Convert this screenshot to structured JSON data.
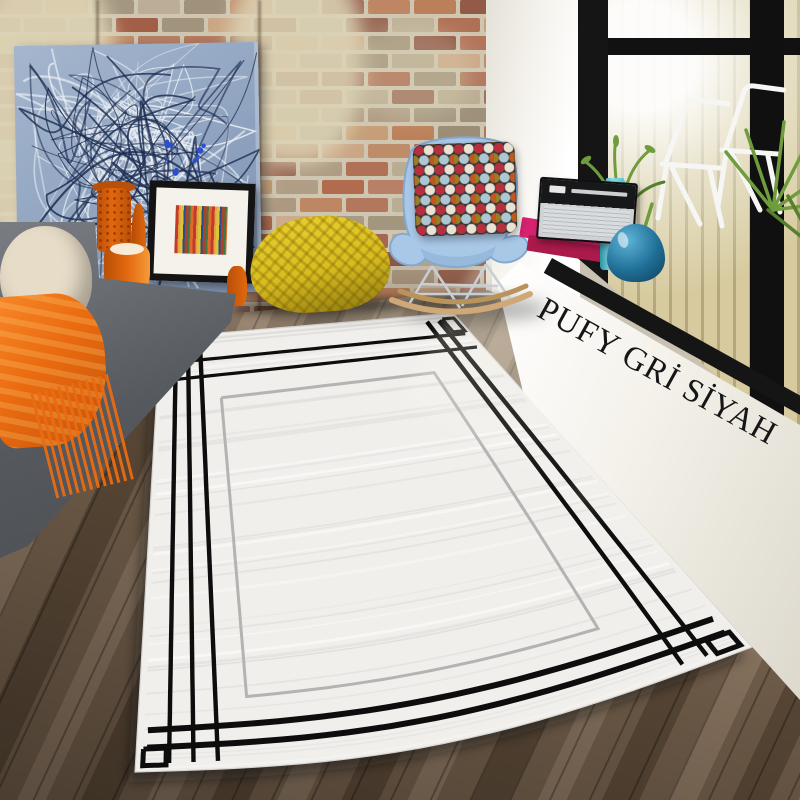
{
  "scene": {
    "description": "Living-room product photo: grey rug with black interlocking geometric border, brick wall, abstract painting, grey sofa with orange throw, yellow knit pouf, blue rocking chair, window ledge with radio, books and vases",
    "sill_text": "PUFY GRİ SİYAH"
  },
  "palette": {
    "wall_mortar": "#cfc6b2",
    "whitewash": "#ddd4b6",
    "white_wall": "#f5f3ed",
    "window_frame": "#151515",
    "slat": "#d6ca9e",
    "slat_dark": "#b5a77a",
    "leaf": "#6f9c3d",
    "leaf_dark": "#567f2e",
    "patio_chair": "#f6f6f4",
    "sill_face": "#f4f1ea",
    "text": "#161616",
    "floor_a": "#8a7560",
    "floor_b": "#74604c",
    "floor_c": "#5c4a38",
    "sofa_a": "#7a7d83",
    "sofa_b": "#55585d",
    "cushion": "#e7dcc7",
    "throw": "#ea6b10",
    "throw_dark": "#c4540a",
    "pouf": "#d9bd1f",
    "pouf_dark": "#8f7a10",
    "shell": "#a9c8e8",
    "shell_dark": "#84a9cf",
    "chrome": "#c9ced3",
    "rocker": "#cfa878",
    "pillow_base": "#30363a",
    "pillow_red": "#b5303c",
    "pillow_cream": "#e9e3d3",
    "pillow_blue": "#aec8d3",
    "pillow_olive": "#9c7d26",
    "pillow_rust": "#c4561f",
    "painting_bg": "#93a7c3",
    "painting_hi": "#eef2f6",
    "painting_navy": "#1c2c50",
    "painting_blue": "#2b4fd0",
    "frame": "#141414",
    "mat": "#f4f2ea",
    "s1": "#c23a2e",
    "s2": "#e7a33b",
    "s3": "#d9c43c",
    "s4": "#2c4b8f",
    "s5": "#a8432c",
    "s6": "#3a7d44",
    "s7": "#e06a2c",
    "vase_orange": "#e2680e",
    "vase_orange_dark": "#b94f08",
    "radio_black": "#17181a",
    "radio_silver": "#ced2d5",
    "book_pink": "#d6236f",
    "book_red": "#ab1a4a",
    "vase_teal": "#49b9c7",
    "vase_teal_dark": "#2d93a6",
    "vase_blue": "#1f6e97",
    "vase_blue_dark": "#123e57"
  },
  "bricks": {
    "mortar": "#cfc6b2",
    "colors": [
      "#a15c45",
      "#ad6b4f",
      "#8f5743",
      "#bb7e58",
      "#c49a70",
      "#b7a98f",
      "#9c8d76",
      "#8a4f3e",
      "#caa584",
      "#a9957c",
      "#b06a4e",
      "#c08a62"
    ]
  },
  "rug": {
    "base_color": "#f0efec",
    "edge_color": "#d6d4d0",
    "black_line_color": "#0d0d0d",
    "grey_line_color": "#b3b3b3",
    "shadow_color": "rgba(25,20,15,0.5)",
    "corners": {
      "top_left": [
        160,
        338
      ],
      "top_right": [
        453,
        313
      ],
      "bottom_right": [
        752,
        647
      ],
      "bottom_left": [
        135,
        772
      ]
    },
    "sag": 34,
    "left_insets": [
      0.055,
      0.095,
      0.135
    ],
    "right_insets": [
      0.895,
      0.935
    ],
    "top_insets": [
      0.06,
      0.1
    ],
    "bottom_insets": [
      0.905,
      0.945
    ],
    "grey_inset_u": 0.19,
    "grey_inset_v": 0.155,
    "line_extent": 0.018,
    "corner_squares": [
      [
        0.012,
        0.012,
        0.05,
        0.05
      ],
      [
        0.95,
        0.014,
        0.988,
        0.052
      ],
      [
        0.95,
        0.948,
        0.988,
        0.986
      ],
      [
        0.012,
        0.948,
        0.05,
        0.986
      ]
    ]
  }
}
